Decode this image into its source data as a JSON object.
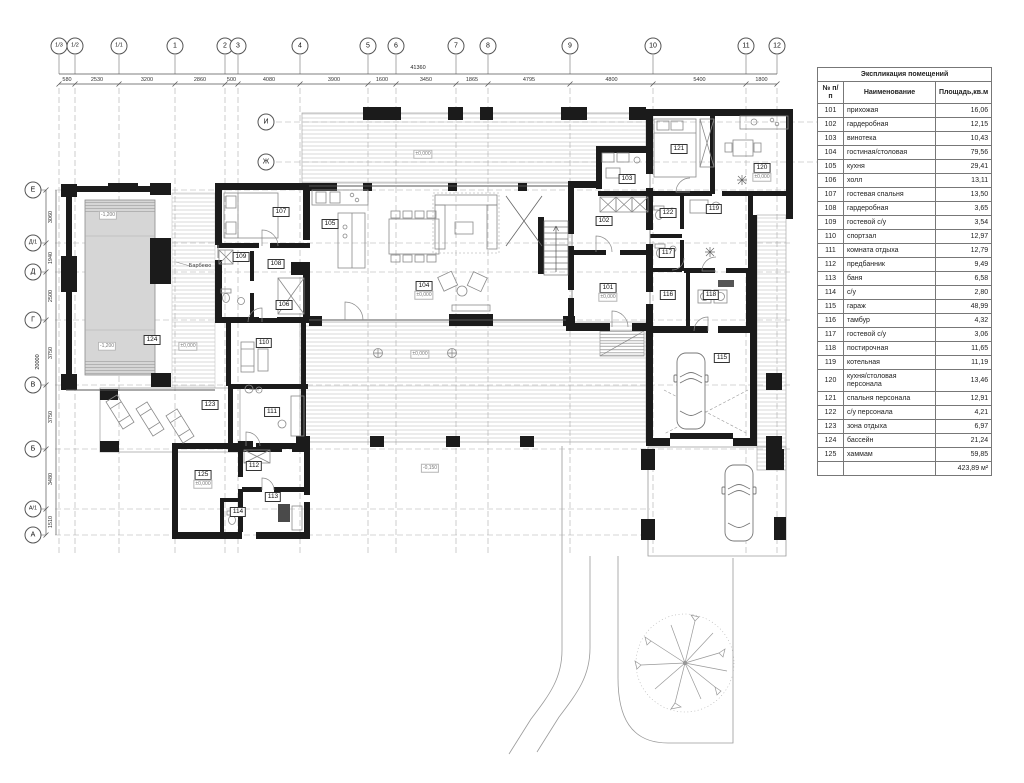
{
  "axes": {
    "top": [
      "1/3",
      "1/2",
      "1/1",
      "1",
      "2",
      "3",
      "4",
      "5",
      "6",
      "7",
      "8",
      "9",
      "10",
      "11",
      "12"
    ],
    "left": [
      "Е",
      "Д/1",
      "Д",
      "Г",
      "В",
      "Б",
      "А/1",
      "А"
    ],
    "inner": [
      "И",
      "Ж"
    ]
  },
  "dimensions": {
    "top": [
      "580",
      "2530",
      "3200",
      "2860",
      "500",
      "4080",
      "3900",
      "1600",
      "3450",
      "1865",
      "4795",
      "4800",
      "5400",
      "1800"
    ],
    "top_total": "41360",
    "left": [
      "3060",
      "1940",
      "2500",
      "3750",
      "3750",
      "3480",
      "1510"
    ],
    "left_total": "20000"
  },
  "plan": {
    "room_labels": [
      {
        "num": "101",
        "elev": "±0,000"
      },
      {
        "num": "102"
      },
      {
        "num": "103"
      },
      {
        "num": "104",
        "elev": "±0,000"
      },
      {
        "num": "105"
      },
      {
        "num": "106"
      },
      {
        "num": "107"
      },
      {
        "num": "108"
      },
      {
        "num": "109"
      },
      {
        "num": "110"
      },
      {
        "num": "111"
      },
      {
        "num": "112"
      },
      {
        "num": "113"
      },
      {
        "num": "114"
      },
      {
        "num": "115"
      },
      {
        "num": "116"
      },
      {
        "num": "117"
      },
      {
        "num": "118"
      },
      {
        "num": "119"
      },
      {
        "num": "120",
        "elev": "±0,000"
      },
      {
        "num": "121"
      },
      {
        "num": "122"
      },
      {
        "num": "123"
      },
      {
        "num": "124"
      },
      {
        "num": "125",
        "elev": "±0,000"
      }
    ],
    "annotations": [
      {
        "id": "terrace-elev",
        "text": "±0,000"
      },
      {
        "id": "deck-elev",
        "text": "±0,000"
      },
      {
        "id": "lower-terrace-elev",
        "text": "-0,150"
      },
      {
        "id": "pool-depth-top",
        "text": "-1,200"
      },
      {
        "id": "pool-depth-bottom",
        "text": "-1,200"
      },
      {
        "id": "pool-deck-elev",
        "text": "±0,000"
      },
      {
        "id": "barbecue-label",
        "text": "Барбекю"
      }
    ]
  },
  "table": {
    "title": "Экспликация помещений",
    "columns": [
      "№ п/п",
      "Наименование",
      "Площадь,кв.м"
    ],
    "rows": [
      [
        "101",
        "прихожая",
        "16,06"
      ],
      [
        "102",
        "гардеробная",
        "12,15"
      ],
      [
        "103",
        "винотека",
        "10,43"
      ],
      [
        "104",
        "гостиная/столовая",
        "79,56"
      ],
      [
        "105",
        "кухня",
        "29,41"
      ],
      [
        "106",
        "холл",
        "13,11"
      ],
      [
        "107",
        "гостевая спальня",
        "13,50"
      ],
      [
        "108",
        "гардеробная",
        "3,65"
      ],
      [
        "109",
        "гостевой с/у",
        "3,54"
      ],
      [
        "110",
        "спортзал",
        "12,97"
      ],
      [
        "111",
        "комната отдыха",
        "12,79"
      ],
      [
        "112",
        "предбанник",
        "9,49"
      ],
      [
        "113",
        "баня",
        "6,58"
      ],
      [
        "114",
        "с/у",
        "2,80"
      ],
      [
        "115",
        "гараж",
        "48,99"
      ],
      [
        "116",
        "тамбур",
        "4,32"
      ],
      [
        "117",
        "гостевой с/у",
        "3,06"
      ],
      [
        "118",
        "постирочная",
        "11,65"
      ],
      [
        "119",
        "котельная",
        "11,19"
      ],
      [
        "120",
        "кухня/столовая персонала",
        "13,46"
      ],
      [
        "121",
        "спальня персонала",
        "12,91"
      ],
      [
        "122",
        "с/у персонала",
        "4,21"
      ],
      [
        "123",
        "зона отдыха",
        "6,97"
      ],
      [
        "124",
        "бассейн",
        "21,24"
      ],
      [
        "125",
        "хаммам",
        "59,85"
      ]
    ],
    "total": "423,89 м²"
  }
}
